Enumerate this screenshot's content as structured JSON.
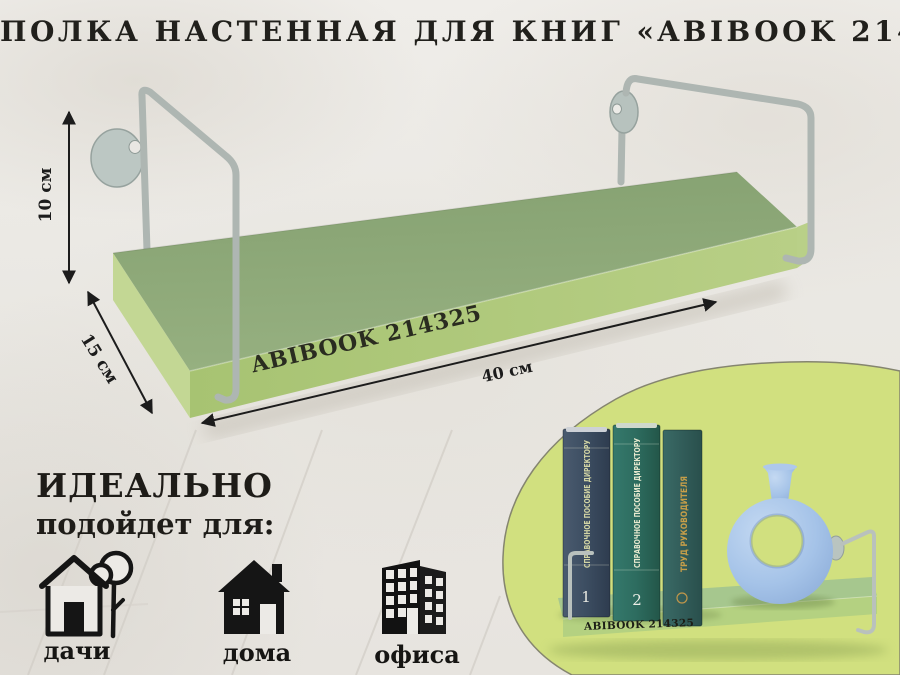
{
  "title": "ПОЛКА НАСТЕННАЯ ДЛЯ КНИГ «ABIBOOK 214325»",
  "dimensions": {
    "height_label": "10 см",
    "depth_label": "15 см",
    "width_label": "40 см"
  },
  "shelf": {
    "front_label": "ABIBOOK 214325"
  },
  "ideal": {
    "line1": "ИДЕАЛЬНО",
    "line2": "подойдет для:",
    "items": [
      {
        "label": "дачи",
        "icon": "house-with-tree-icon"
      },
      {
        "label": "дома",
        "icon": "house-icon"
      },
      {
        "label": "офиса",
        "icon": "office-building-icon"
      }
    ]
  },
  "inset": {
    "shelf_label": "ABIBOOK 214325",
    "books": [
      {
        "spine": "СПРАВОЧНОЕ ПОСОБИЕ ДИРЕКТОРУ",
        "volume": "1"
      },
      {
        "spine": "СПРАВОЧНОЕ ПОСОБИЕ ДИРЕКТОРУ",
        "volume": "2"
      },
      {
        "spine": "ТРУД РУКОВОДИТЕЛЯ",
        "volume": ""
      }
    ],
    "decor_item": "vase"
  },
  "colors": {
    "shelf_top_green": "#8ea97b",
    "shelf_edge_green": "#b0ca7e",
    "panel_green": "#d1e07f",
    "bracket_gray": "#b3bbb7",
    "vase_blue": "#a5c3e8",
    "text_dark": "#21201c"
  }
}
